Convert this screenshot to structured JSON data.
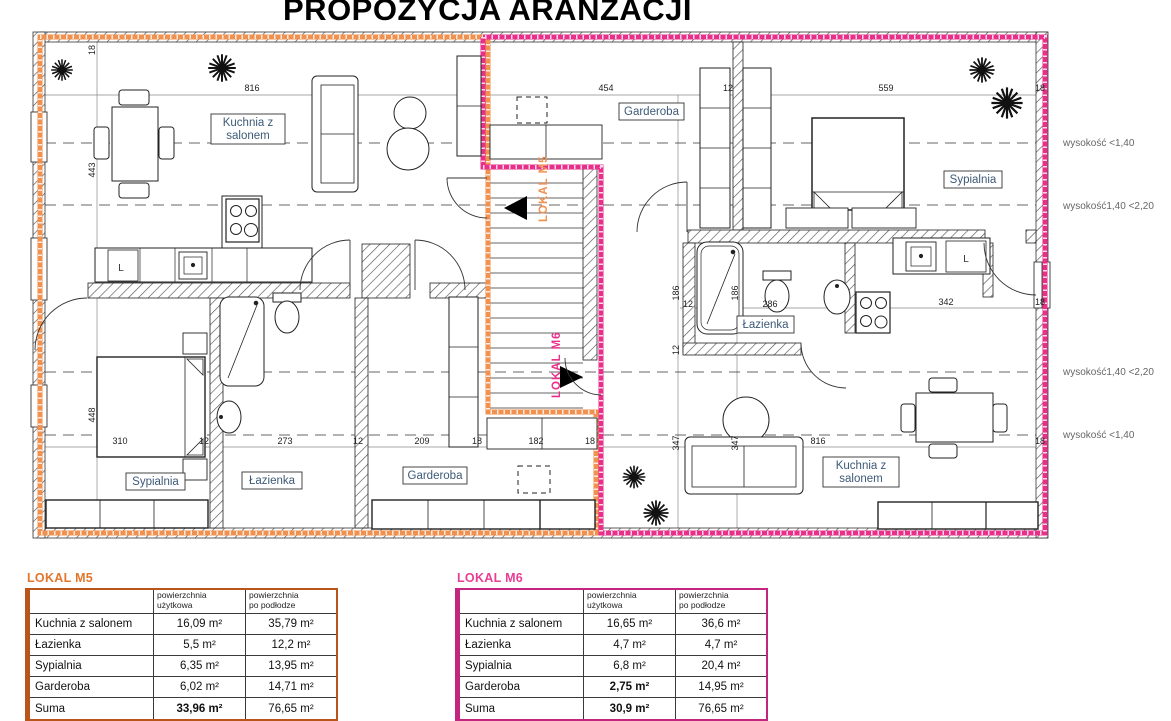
{
  "title": "PROPOZYCJA ARANŻACJI",
  "colors": {
    "m5_boundary": "#F0914F",
    "m6_boundary": "#E8308A",
    "m5_table_border": "#B9541B",
    "m5_table_title": "#E2762D",
    "m6_table_border": "#C2267E",
    "m6_table_title": "#E83E93",
    "room_label_text": "#3D5A78",
    "height_label_text": "#666666"
  },
  "plan": {
    "unit_labels": [
      {
        "text": "LOKAL M5",
        "x": 547,
        "y": 222,
        "color": "#F0914F"
      },
      {
        "text": "LOKAL M6",
        "x": 560,
        "y": 398,
        "color": "#E8308A"
      }
    ],
    "room_labels": [
      {
        "x": 211,
        "y": 114,
        "w": 74,
        "h": 30,
        "lines": [
          "Kuchnia z",
          "salonem"
        ]
      },
      {
        "x": 126,
        "y": 473,
        "w": 59,
        "h": 17,
        "lines": [
          "Sypialnia"
        ]
      },
      {
        "x": 242,
        "y": 472,
        "w": 60,
        "h": 17,
        "lines": [
          "Łazienka"
        ]
      },
      {
        "x": 403,
        "y": 467,
        "w": 64,
        "h": 17,
        "lines": [
          "Garderoba"
        ]
      },
      {
        "x": 619,
        "y": 103,
        "w": 65,
        "h": 17,
        "lines": [
          "Garderoba"
        ]
      },
      {
        "x": 944,
        "y": 171,
        "w": 58,
        "h": 17,
        "lines": [
          "Sypialnia"
        ]
      },
      {
        "x": 737,
        "y": 316,
        "w": 57,
        "h": 17,
        "lines": [
          "Łazienka"
        ]
      },
      {
        "x": 823,
        "y": 457,
        "w": 76,
        "h": 30,
        "lines": [
          "Kuchnia z",
          "salonem"
        ]
      }
    ],
    "height_labels": [
      {
        "text": "wysokość <1,40",
        "y": 146
      },
      {
        "text": "wysokość1,40 <2,20",
        "y": 209
      },
      {
        "text": "wysokość1,40 <2,20",
        "y": 375
      },
      {
        "text": "wysokość <1,40",
        "y": 438
      }
    ],
    "fixture_labels": [
      {
        "text": "L",
        "x": 121,
        "y": 271
      },
      {
        "text": "L",
        "x": 966,
        "y": 262
      }
    ],
    "dimensions": [
      {
        "t": "18",
        "x": 95,
        "y": 50,
        "r": 1
      },
      {
        "t": "816",
        "x": 252,
        "y": 91
      },
      {
        "t": "454",
        "x": 606,
        "y": 91
      },
      {
        "t": "12",
        "x": 728,
        "y": 91
      },
      {
        "t": "559",
        "x": 886,
        "y": 91
      },
      {
        "t": "18",
        "x": 1040,
        "y": 91
      },
      {
        "t": "443",
        "x": 95,
        "y": 170,
        "r": 1
      },
      {
        "t": "448",
        "x": 95,
        "y": 415,
        "r": 1
      },
      {
        "t": "186",
        "x": 679,
        "y": 293,
        "r": 1
      },
      {
        "t": "186",
        "x": 738,
        "y": 293,
        "r": 1
      },
      {
        "t": "12",
        "x": 679,
        "y": 350,
        "r": 1
      },
      {
        "t": "347",
        "x": 679,
        "y": 443,
        "r": 1
      },
      {
        "t": "347",
        "x": 738,
        "y": 443,
        "r": 1
      },
      {
        "t": "310",
        "x": 120,
        "y": 444
      },
      {
        "t": "12",
        "x": 204,
        "y": 444
      },
      {
        "t": "273",
        "x": 285,
        "y": 444
      },
      {
        "t": "12",
        "x": 358,
        "y": 444
      },
      {
        "t": "209",
        "x": 422,
        "y": 444
      },
      {
        "t": "18",
        "x": 477,
        "y": 444
      },
      {
        "t": "182",
        "x": 536,
        "y": 444
      },
      {
        "t": "18",
        "x": 590,
        "y": 444
      },
      {
        "t": "816",
        "x": 818,
        "y": 444
      },
      {
        "t": "18",
        "x": 1040,
        "y": 444
      },
      {
        "t": "12",
        "x": 688,
        "y": 307
      },
      {
        "t": "286",
        "x": 770,
        "y": 307
      },
      {
        "t": "342",
        "x": 946,
        "y": 305
      },
      {
        "t": "18",
        "x": 1040,
        "y": 305
      }
    ]
  },
  "tables": [
    {
      "id": "m5",
      "title": "LOKAL M5",
      "left": 25,
      "accent": "#E2762D",
      "border": "#B9541B",
      "headers": [
        [
          "powierzchnia",
          "użytkowa"
        ],
        [
          "powierzchnia",
          "po podłodze"
        ]
      ],
      "rows": [
        [
          "Kuchnia z salonem",
          "16,09 m²",
          "35,79 m²"
        ],
        [
          "Łazienka",
          "5,5 m²",
          "12,2 m²"
        ],
        [
          "Sypialnia",
          "6,35 m²",
          "13,95 m²"
        ],
        [
          "Garderoba",
          "6,02 m²",
          "14,71 m²"
        ],
        [
          "Suma",
          "33,96 m²",
          "76,65 m²"
        ]
      ],
      "bold_cells": [
        [
          4,
          1
        ]
      ]
    },
    {
      "id": "m6",
      "title": "LOKAL M6",
      "left": 455,
      "accent": "#E83E93",
      "border": "#C2267E",
      "headers": [
        [
          "powierzchnia",
          "użytkowa"
        ],
        [
          "powierzchnia",
          "po podłodze"
        ]
      ],
      "rows": [
        [
          "Kuchnia z salonem",
          "16,65 m²",
          "36,6 m²"
        ],
        [
          "Łazienka",
          "4,7 m²",
          "4,7 m²"
        ],
        [
          "Sypialnia",
          "6,8 m²",
          "20,4 m²"
        ],
        [
          "Garderoba",
          "2,75 m²",
          "14,95 m²"
        ],
        [
          "Suma",
          "30,9 m²",
          "76,65 m²"
        ]
      ],
      "bold_cells": [
        [
          3,
          1
        ],
        [
          4,
          1
        ]
      ]
    }
  ]
}
